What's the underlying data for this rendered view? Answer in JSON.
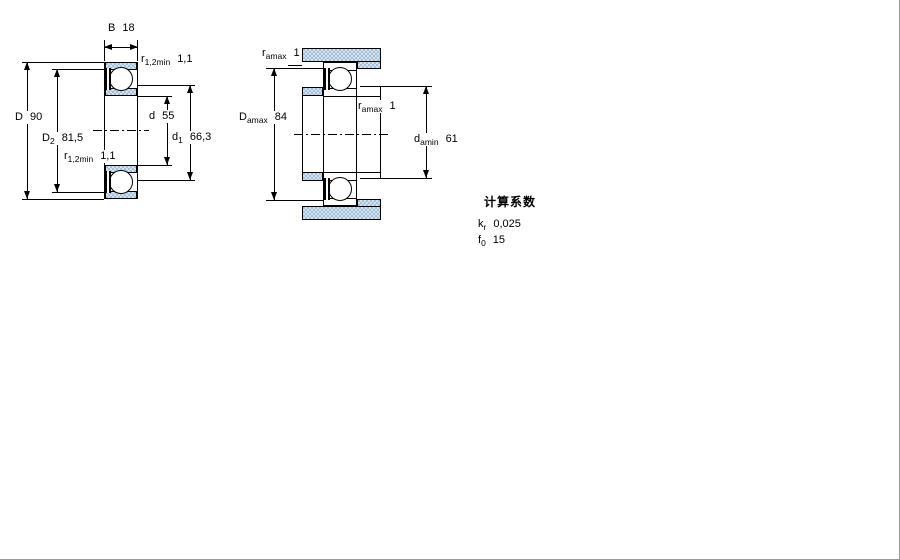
{
  "left_view": {
    "B": {
      "sym": "B",
      "val": "18"
    },
    "r_top": {
      "sym": "r",
      "sub": "1,2min",
      "val": "1,1"
    },
    "D": {
      "sym": "D",
      "val": "90"
    },
    "D2": {
      "sym": "D",
      "sub": "2",
      "val": "81,5"
    },
    "d": {
      "sym": "d",
      "val": "55"
    },
    "d1": {
      "sym": "d",
      "sub": "1",
      "val": "66,3"
    },
    "r_bottom": {
      "sym": "r",
      "sub": "1,2min",
      "val": "1,1"
    }
  },
  "right_view": {
    "r_a_top": {
      "sym": "r",
      "sub": "amax",
      "val": "1"
    },
    "Da": {
      "sym": "D",
      "sub": "amax",
      "val": "84"
    },
    "r_a_mid": {
      "sym": "r",
      "sub": "amax",
      "val": "1"
    },
    "da": {
      "sym": "d",
      "sub": "amin",
      "val": "61"
    }
  },
  "calculation_factors": {
    "title": "计算系数",
    "kr": {
      "sym": "k",
      "sub": "r",
      "val": "0,025"
    },
    "f0": {
      "sym": "f",
      "sub": "0",
      "val": "15"
    }
  },
  "colors": {
    "steel_base": "#a6c0d8",
    "steel_light": "#d2e2ef",
    "line": "#000000"
  }
}
